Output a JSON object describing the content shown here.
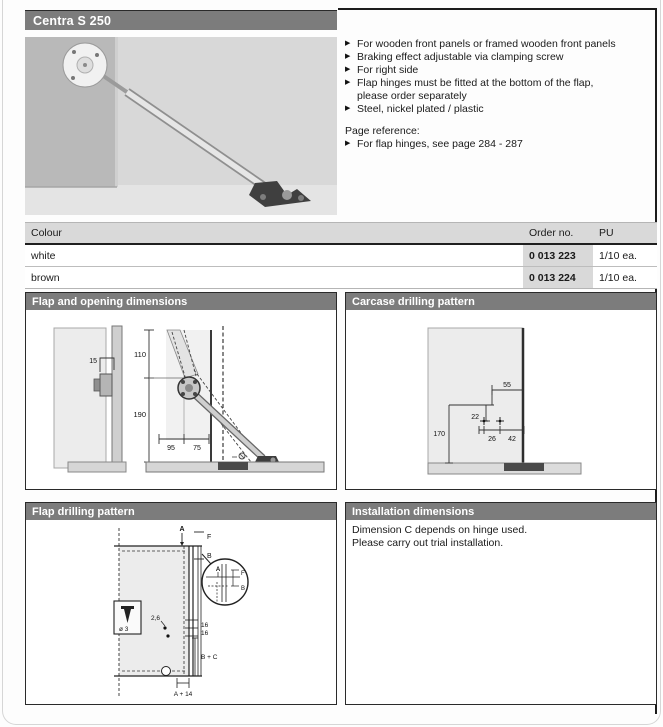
{
  "colors": {
    "panel_header_bg": "#7c7c7c",
    "panel_header_text": "#ffffff",
    "table_shade": "#d9d9d9",
    "drawing_fill": "#ececec"
  },
  "title_bar": {
    "title": "Centra S 250"
  },
  "features": {
    "marker": "▶",
    "items": [
      "For wooden front panels or framed wooden front panels",
      "Braking effect adjustable via clamping screw",
      "For right side",
      "Flap hinges must be fitted at the bottom of the flap,\nplease order separately",
      "Steel, nickel plated / plastic"
    ],
    "page_reference_label": "Page reference:",
    "page_reference_item": "For flap hinges, see page 284 - 287"
  },
  "order_table": {
    "headers": {
      "colour": "Colour",
      "order_no": "Order no.",
      "pu": "PU"
    },
    "rows": [
      {
        "colour": "white",
        "order_no": "0 013 223",
        "pu": "1/10 ea."
      },
      {
        "colour": "brown",
        "order_no": "0 013 224",
        "pu": "1/10 ea."
      }
    ]
  },
  "panels": {
    "flap_opening": {
      "title": "Flap and opening dimensions",
      "dims": {
        "offset": "15",
        "upper": "110",
        "lower": "190",
        "depth_a": "95",
        "depth_b": "75"
      }
    },
    "carcase": {
      "title": "Carcase drilling pattern",
      "dims": {
        "top": "55",
        "small": "22",
        "height": "170",
        "hole_a": "26",
        "hole_b": "42"
      }
    },
    "flap_drilling": {
      "title": "Flap drilling pattern",
      "labels": {
        "top_a": "A",
        "top_f": "F",
        "top_b": "B",
        "detail_a": "A",
        "detail_f": "F",
        "detail_b": "B",
        "pilot": "2,6",
        "s16_1": "16",
        "s16_2": "16",
        "bc": "B + C",
        "a14": "A + 14",
        "screw": "ø 3"
      }
    },
    "installation": {
      "title": "Installation dimensions",
      "lines": [
        "Dimension C depends on hinge used.",
        "Please carry out trial installation."
      ]
    }
  }
}
